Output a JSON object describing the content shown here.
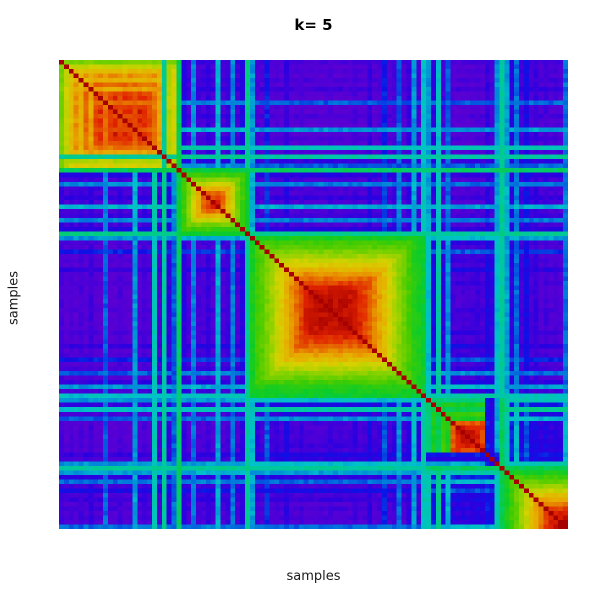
{
  "title": "k= 5",
  "xlabel": "samples",
  "ylabel": "samples",
  "colors": {
    "background": "#ffffff",
    "title_text": "#000000",
    "axis_text": "#1a1a1a"
  },
  "chart_data": {
    "type": "heatmap",
    "title": "k= 5",
    "xlabel": "samples",
    "ylabel": "samples",
    "k": 5,
    "n_samples": 104,
    "value_range": [
      0,
      1
    ],
    "grid": false,
    "legend_position": "none",
    "cluster_sizes": [
      24,
      15,
      36,
      15,
      14
    ],
    "within_strength": [
      0.62,
      0.7,
      0.76,
      0.82,
      0.78,
      0.86,
      0.8,
      0.9,
      0.93,
      0.86,
      0.92,
      0.95,
      0.9,
      0.95,
      0.92,
      0.88,
      0.96,
      0.93,
      0.9,
      0.85,
      0.8,
      0.38,
      0.68,
      0.72,
      0.46,
      0.55,
      0.63,
      0.7,
      0.78,
      0.86,
      0.9,
      0.95,
      0.92,
      0.86,
      0.78,
      0.7,
      0.62,
      0.55,
      0.48,
      0.5,
      0.55,
      0.58,
      0.62,
      0.66,
      0.7,
      0.74,
      0.78,
      0.82,
      0.86,
      0.9,
      0.94,
      0.96,
      0.97,
      0.97,
      0.97,
      0.97,
      0.97,
      0.97,
      0.97,
      0.96,
      0.95,
      0.93,
      0.9,
      0.87,
      0.84,
      0.8,
      0.76,
      0.72,
      0.68,
      0.64,
      0.6,
      0.56,
      0.52,
      0.5,
      0.48,
      0.42,
      0.5,
      0.45,
      0.55,
      0.5,
      0.88,
      0.94,
      0.96,
      0.95,
      0.96,
      0.94,
      0.9,
      0.2,
      0.15,
      0.3,
      0.45,
      0.5,
      0.55,
      0.6,
      0.65,
      0.7,
      0.75,
      0.8,
      0.85,
      0.9,
      0.93,
      0.96,
      0.98,
      1.0
    ],
    "cross_noise": [
      0.1,
      0.05,
      0.08,
      0.02,
      0.1,
      0.05,
      0.12,
      0.05,
      0.02,
      0.3,
      0.05,
      0.02,
      0.1,
      0.05,
      0.02,
      0.35,
      0.05,
      0.1,
      0.05,
      0.42,
      0.08,
      0.45,
      0.15,
      0.3,
      0.5,
      0.15,
      0.05,
      0.3,
      0.08,
      0.05,
      0.12,
      0.05,
      0.35,
      0.05,
      0.1,
      0.3,
      0.05,
      0.15,
      0.45,
      0.35,
      0.1,
      0.05,
      0.25,
      0.05,
      0.08,
      0.03,
      0.15,
      0.05,
      0.02,
      0.08,
      0.03,
      0.02,
      0.05,
      0.02,
      0.02,
      0.08,
      0.02,
      0.05,
      0.02,
      0.03,
      0.1,
      0.02,
      0.05,
      0.15,
      0.03,
      0.08,
      0.25,
      0.05,
      0.1,
      0.3,
      0.05,
      0.15,
      0.35,
      0.1,
      0.4,
      0.35,
      0.15,
      0.4,
      0.1,
      0.3,
      0.05,
      0.02,
      0.05,
      0.02,
      0.05,
      0.08,
      0.05,
      0.15,
      0.1,
      0.35,
      0.45,
      0.35,
      0.15,
      0.3,
      0.1,
      0.2,
      0.08,
      0.12,
      0.05,
      0.1,
      0.04,
      0.08,
      0.05,
      0.3
    ],
    "between_cluster_base": [
      [
        1.0,
        0.06,
        0.03,
        0.03,
        0.04
      ],
      [
        0.06,
        1.0,
        0.05,
        0.04,
        0.05
      ],
      [
        0.03,
        0.05,
        1.0,
        0.07,
        0.04
      ],
      [
        0.03,
        0.04,
        0.07,
        1.0,
        0.1
      ],
      [
        0.04,
        0.05,
        0.04,
        0.1,
        1.0
      ]
    ],
    "cross_gain": 0.85,
    "cross_exponent": 1.15,
    "cross_cap": 0.52,
    "jitter": 0.04,
    "diagonal_value": 1.0,
    "palette_stops": [
      [
        0.0,
        "#6600CE"
      ],
      [
        0.08,
        "#4F00D6"
      ],
      [
        0.14,
        "#2B00E0"
      ],
      [
        0.2,
        "#0A14E6"
      ],
      [
        0.26,
        "#0078DC"
      ],
      [
        0.32,
        "#00C0CC"
      ],
      [
        0.4,
        "#00CC88"
      ],
      [
        0.48,
        "#0ACC2A"
      ],
      [
        0.56,
        "#44CC00"
      ],
      [
        0.64,
        "#8CD200"
      ],
      [
        0.72,
        "#D6D200"
      ],
      [
        0.8,
        "#E8A800"
      ],
      [
        0.87,
        "#E66000"
      ],
      [
        0.93,
        "#E02200"
      ],
      [
        1.0,
        "#A60000"
      ]
    ]
  }
}
